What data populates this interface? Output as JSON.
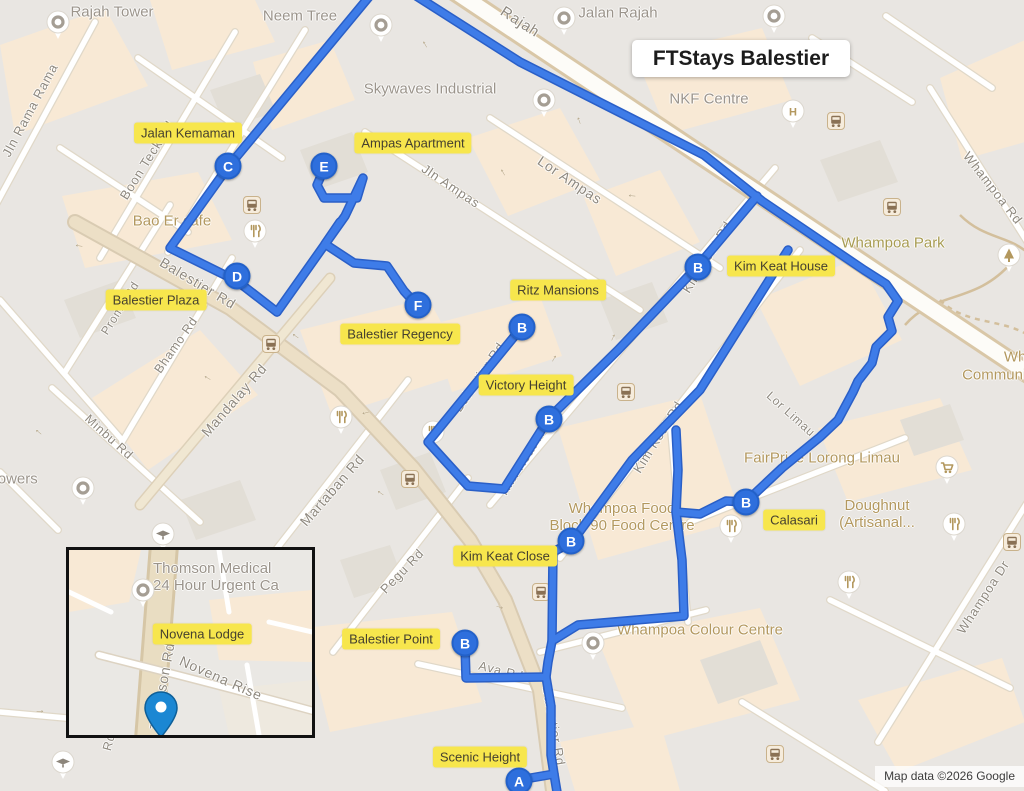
{
  "title": {
    "text": "FTStays Balestier"
  },
  "attribution": {
    "text": "Map data ©2026 Google"
  },
  "colors": {
    "route": "#3e7ce8",
    "route_casing": "#2a5fc7",
    "marker_fill": "#2e6fdd",
    "highlight_label_bg": "#f7e64d",
    "poi_tan": "#b3985e",
    "poi_gray": "#9b948b",
    "inset_pin": "#1b87d3",
    "map_bg": "#e9e6e2"
  },
  "markers": [
    {
      "letter": "A",
      "x": 519,
      "y": 781,
      "name": "marker-a-scenic-height"
    },
    {
      "letter": "B",
      "x": 522,
      "y": 327,
      "name": "marker-b-ritz-mansions"
    },
    {
      "letter": "B",
      "x": 698,
      "y": 267,
      "name": "marker-b-kim-keat-house"
    },
    {
      "letter": "B",
      "x": 549,
      "y": 419,
      "name": "marker-b-victory-height"
    },
    {
      "letter": "B",
      "x": 571,
      "y": 541,
      "name": "marker-b-kim-keat-close"
    },
    {
      "letter": "B",
      "x": 746,
      "y": 502,
      "name": "marker-b-calasari"
    },
    {
      "letter": "B",
      "x": 465,
      "y": 643,
      "name": "marker-b-balestier-point"
    },
    {
      "letter": "C",
      "x": 228,
      "y": 166,
      "name": "marker-c-jalan-kemaman"
    },
    {
      "letter": "D",
      "x": 237,
      "y": 276,
      "name": "marker-d-balestier-plaza"
    },
    {
      "letter": "E",
      "x": 324,
      "y": 166,
      "name": "marker-e-ampas-apartment"
    },
    {
      "letter": "F",
      "x": 418,
      "y": 305,
      "name": "marker-f-balestier-regency"
    }
  ],
  "property_labels": [
    {
      "text": "Jalan Kemaman",
      "x": 188,
      "y": 133
    },
    {
      "text": "Ampas Apartment",
      "x": 413,
      "y": 143
    },
    {
      "text": "Kim Keat House",
      "x": 781,
      "y": 266
    },
    {
      "text": "Balestier Plaza",
      "x": 156,
      "y": 300
    },
    {
      "text": "Ritz Mansions",
      "x": 558,
      "y": 290
    },
    {
      "text": "Balestier Regency",
      "x": 400,
      "y": 334
    },
    {
      "text": "Victory Height",
      "x": 526,
      "y": 385
    },
    {
      "text": "Calasari",
      "x": 794,
      "y": 520
    },
    {
      "text": "Kim Keat Close",
      "x": 505,
      "y": 556
    },
    {
      "text": "Balestier Point",
      "x": 391,
      "y": 639
    },
    {
      "text": "Scenic Height",
      "x": 480,
      "y": 757
    }
  ],
  "street_labels": [
    {
      "text": "Jln Rama Rama",
      "x": 30,
      "y": 110,
      "rot": -62,
      "size": 13
    },
    {
      "text": "Boon Teck Rd",
      "x": 147,
      "y": 160,
      "rot": -58,
      "size": 13
    },
    {
      "text": "Prome Rd",
      "x": 120,
      "y": 308,
      "rot": -58,
      "size": 12
    },
    {
      "text": "Balestier Rd",
      "x": 198,
      "y": 283,
      "rot": 31,
      "size": 14
    },
    {
      "text": "Bhamo Rd",
      "x": 176,
      "y": 345,
      "rot": -55,
      "size": 12.5
    },
    {
      "text": "Mandalay Rd",
      "x": 234,
      "y": 400,
      "rot": -49,
      "size": 14
    },
    {
      "text": "Minbu Rd",
      "x": 109,
      "y": 437,
      "rot": 42,
      "size": 12.5
    },
    {
      "text": "Martaban Rd",
      "x": 332,
      "y": 490,
      "rot": -49,
      "size": 14
    },
    {
      "text": "Pegu Rd",
      "x": 402,
      "y": 571,
      "rot": -46,
      "size": 13
    },
    {
      "text": "Jln Ampas",
      "x": 451,
      "y": 186,
      "rot": 34,
      "size": 13
    },
    {
      "text": "Lor Ampas",
      "x": 570,
      "y": 180,
      "rot": 34,
      "size": 14
    },
    {
      "text": "Rajah",
      "x": 520,
      "y": 22,
      "rot": 33,
      "size": 15
    },
    {
      "text": "Kim Keat Rd",
      "x": 707,
      "y": 257,
      "rot": -58,
      "size": 13
    },
    {
      "text": "Kim Keat Rd",
      "x": 524,
      "y": 459,
      "rot": -58,
      "size": 13
    },
    {
      "text": "Kim Keat Rd",
      "x": 658,
      "y": 437,
      "rot": -58,
      "size": 13
    },
    {
      "text": "Lor Limau",
      "x": 791,
      "y": 414,
      "rot": 42,
      "size": 12
    },
    {
      "text": "Balestier Rd",
      "x": 479,
      "y": 377,
      "rot": -56,
      "size": 13
    },
    {
      "text": "Balestier Rd",
      "x": 554,
      "y": 726,
      "rot": 80,
      "size": 13
    },
    {
      "text": "Ava Rd",
      "x": 501,
      "y": 671,
      "rot": 14,
      "size": 12.5
    },
    {
      "text": "Whampoa Rd",
      "x": 993,
      "y": 188,
      "rot": 52,
      "size": 13
    },
    {
      "text": "Whampoa Dr",
      "x": 983,
      "y": 597,
      "rot": -57,
      "size": 13
    },
    {
      "text": "Rd",
      "x": 109,
      "y": 742,
      "rot": -75,
      "size": 12.5
    }
  ],
  "poi_labels": [
    {
      "lines": [
        "Rajah Tower"
      ],
      "x": 112,
      "y": 12,
      "color": "gray",
      "size": 15
    },
    {
      "lines": [
        "Neem Tree"
      ],
      "x": 300,
      "y": 16,
      "color": "gray",
      "size": 15
    },
    {
      "lines": [
        "Jalan Rajah"
      ],
      "x": 618,
      "y": 13,
      "color": "gray",
      "size": 15
    },
    {
      "lines": [
        "Skywaves Industrial"
      ],
      "x": 430,
      "y": 89,
      "color": "gray",
      "size": 15
    },
    {
      "lines": [
        "NKF Centre"
      ],
      "x": 709,
      "y": 99,
      "color": "gray",
      "size": 15
    },
    {
      "lines": [
        "Whampoa Park"
      ],
      "x": 893,
      "y": 243,
      "color": "park",
      "size": 15
    },
    {
      "lines": [
        "Bao Er cafe"
      ],
      "x": 172,
      "y": 221,
      "color": "tan",
      "size": 15
    },
    {
      "lines": [
        "Towers"
      ],
      "x": 14,
      "y": 479,
      "color": "gray",
      "size": 15
    },
    {
      "lines": [
        "FairPrice Lorong Limau"
      ],
      "x": 822,
      "y": 458,
      "color": "tan",
      "size": 15
    },
    {
      "lines": [
        "Doughnut",
        "(Artisanal..."
      ],
      "x": 877,
      "y": 514,
      "color": "tan",
      "size": 15
    },
    {
      "lines": [
        "Whampoa Food",
        "Block 90 Food Centre"
      ],
      "x": 622,
      "y": 517,
      "color": "tan",
      "size": 15
    },
    {
      "lines": [
        "Whampoa Colour Centre"
      ],
      "x": 700,
      "y": 630,
      "color": "tan",
      "size": 15
    },
    {
      "lines": [
        "Whampoa"
      ],
      "x": 1038,
      "y": 357,
      "color": "tan",
      "size": 15
    },
    {
      "lines": [
        "Community"
      ],
      "x": 1000,
      "y": 375,
      "color": "tan",
      "size": 15
    }
  ],
  "poi_icons": [
    {
      "type": "generic",
      "x": 45,
      "y": 10
    },
    {
      "type": "generic",
      "x": 368,
      "y": 13
    },
    {
      "type": "generic",
      "x": 551,
      "y": 6
    },
    {
      "type": "generic",
      "x": 761,
      "y": 4
    },
    {
      "type": "generic",
      "x": 531,
      "y": 88
    },
    {
      "type": "hospital",
      "x": 780,
      "y": 99
    },
    {
      "type": "tree",
      "x": 996,
      "y": 243
    },
    {
      "type": "food",
      "x": 242,
      "y": 219
    },
    {
      "type": "generic",
      "x": 70,
      "y": 476
    },
    {
      "type": "cart",
      "x": 934,
      "y": 455
    },
    {
      "type": "food",
      "x": 941,
      "y": 512
    },
    {
      "type": "food",
      "x": 836,
      "y": 570
    },
    {
      "type": "food",
      "x": 718,
      "y": 514
    },
    {
      "type": "food",
      "x": 328,
      "y": 405
    },
    {
      "type": "food",
      "x": 420,
      "y": 420
    },
    {
      "type": "generic",
      "x": 580,
      "y": 631
    },
    {
      "type": "grad",
      "x": 150,
      "y": 522
    },
    {
      "type": "grad",
      "x": 50,
      "y": 750
    }
  ],
  "bus_stops": [
    [
      243,
      196
    ],
    [
      827,
      112
    ],
    [
      883,
      198
    ],
    [
      262,
      335
    ],
    [
      401,
      470
    ],
    [
      617,
      383
    ],
    [
      532,
      583
    ],
    [
      1003,
      533
    ],
    [
      766,
      745
    ]
  ],
  "arrows": [
    [
      79,
      247,
      190
    ],
    [
      424,
      45,
      240
    ],
    [
      578,
      121,
      250
    ],
    [
      632,
      197,
      185
    ],
    [
      502,
      173,
      240
    ],
    [
      553,
      358,
      -60
    ],
    [
      612,
      337,
      -65
    ],
    [
      295,
      337,
      215
    ],
    [
      366,
      414,
      165
    ],
    [
      380,
      494,
      215
    ],
    [
      500,
      606,
      15
    ],
    [
      38,
      433,
      220
    ],
    [
      40,
      710,
      0
    ],
    [
      207,
      379,
      210
    ],
    [
      296,
      560,
      210
    ]
  ],
  "inset": {
    "property_labels": [
      {
        "text": "Novena Lodge",
        "x": 133,
        "y": 84
      }
    ],
    "street_labels": [
      {
        "text": "Thomson Rd",
        "x": 93,
        "y": 136,
        "rot": -80,
        "size": 14
      },
      {
        "text": "Novena Rise",
        "x": 152,
        "y": 128,
        "rot": 24,
        "size": 14
      }
    ],
    "poi_labels": [
      {
        "lines": [
          "Thomson Medical",
          "24 Hour Urgent Ca"
        ],
        "x": 84,
        "y": 10,
        "color": "gray",
        "size": 15,
        "align": "left"
      }
    ],
    "poi_icons": [
      {
        "type": "generic",
        "x": 61,
        "y": 28
      }
    ],
    "pin": {
      "x": 75,
      "y": 141
    }
  }
}
